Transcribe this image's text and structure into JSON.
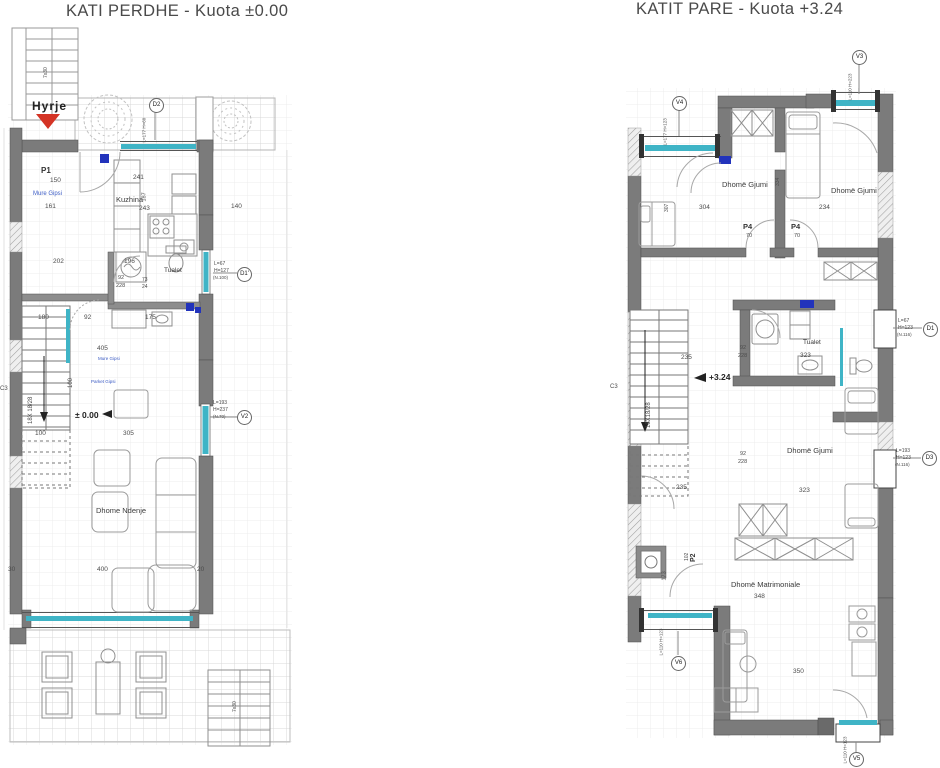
{
  "colors": {
    "accent_cyan": "#3fb4c6",
    "entrance_red": "#d43425",
    "note_blue": "#3b5bc4",
    "wall_gray": "#7b7b7b"
  },
  "left_plan": {
    "title": "KATI PERDHE - Kuota ±0.00",
    "entrance": "Hyrje",
    "level": "± 0.00",
    "rooms": {
      "kitchen": "Kuzhina",
      "toilet": "Tualet",
      "living": "Dhome Ndenje"
    },
    "notes": {
      "wall1": "Mure Gipsi",
      "wall2": "Mure Gipsi",
      "floor": "Parket Gipsi"
    },
    "tags": {
      "d2": "D2",
      "d1": "D1'",
      "v2": "V2"
    },
    "dims": [
      {
        "t": "7x30",
        "x": 49,
        "y": 78,
        "r": -90,
        "s": 5
      },
      {
        "t": "L=177 H=60",
        "x": 147,
        "y": 142,
        "r": -90,
        "s": 4.5
      },
      {
        "t": "P1",
        "x": 41,
        "y": 167,
        "s": 8,
        "c": "b"
      },
      {
        "t": "150",
        "x": 50,
        "y": 178,
        "s": 6.5
      },
      {
        "t": "241",
        "x": 133,
        "y": 175,
        "s": 6.5
      },
      {
        "t": "187",
        "x": 148,
        "y": 201,
        "r": -90,
        "s": 5.5
      },
      {
        "t": "243",
        "x": 139,
        "y": 206,
        "s": 6.5
      },
      {
        "t": "140",
        "x": 231,
        "y": 204,
        "s": 6.5
      },
      {
        "t": "161",
        "x": 45,
        "y": 204,
        "s": 6.5
      },
      {
        "t": "202",
        "x": 53,
        "y": 259,
        "s": 6.5
      },
      {
        "t": "196",
        "x": 124,
        "y": 259,
        "s": 6.5
      },
      {
        "t": "92",
        "x": 118,
        "y": 276,
        "s": 5.5
      },
      {
        "t": "228",
        "x": 116,
        "y": 284,
        "s": 5.5
      },
      {
        "t": "73",
        "x": 142,
        "y": 278,
        "s": 5
      },
      {
        "t": "24",
        "x": 142,
        "y": 285,
        "s": 5
      },
      {
        "t": "L=67",
        "x": 214,
        "y": 262,
        "s": 5
      },
      {
        "t": "H=127",
        "x": 214,
        "y": 269,
        "s": 5
      },
      {
        "t": "(N.100)",
        "x": 213,
        "y": 276,
        "s": 4.5
      },
      {
        "t": "180",
        "x": 38,
        "y": 315,
        "s": 6.5
      },
      {
        "t": "92",
        "x": 84,
        "y": 315,
        "s": 6.5
      },
      {
        "t": "175",
        "x": 145,
        "y": 315,
        "s": 6.5
      },
      {
        "t": "405",
        "x": 97,
        "y": 346,
        "s": 6.5
      },
      {
        "t": "100",
        "x": 74,
        "y": 388,
        "r": -90,
        "s": 6
      },
      {
        "t": "18X 18/28",
        "x": 34,
        "y": 424,
        "r": -90,
        "s": 6
      },
      {
        "t": "L=193",
        "x": 213,
        "y": 401,
        "s": 5
      },
      {
        "t": "H=237",
        "x": 213,
        "y": 408,
        "s": 5
      },
      {
        "t": "(N.70)",
        "x": 213,
        "y": 415,
        "s": 4.5
      },
      {
        "t": "100",
        "x": 35,
        "y": 431,
        "s": 6.5
      },
      {
        "t": "305",
        "x": 123,
        "y": 431,
        "s": 6.5
      },
      {
        "t": "30",
        "x": 8,
        "y": 567,
        "s": 6.5
      },
      {
        "t": "400",
        "x": 97,
        "y": 567,
        "s": 6.5
      },
      {
        "t": "20",
        "x": 197,
        "y": 567,
        "s": 6.5
      },
      {
        "t": "7x30",
        "x": 238,
        "y": 712,
        "r": -90,
        "s": 5
      },
      {
        "t": "C3",
        "x": 0,
        "y": 386,
        "s": 6
      }
    ]
  },
  "right_plan": {
    "title": "KATIT PARE -  Kuota +3.24",
    "level": "+3.24",
    "rooms": {
      "bedroom1": "Dhomë Gjumi",
      "bedroom2": "Dhomë Gjumi",
      "bedroom3": "Dhomë Gjumi",
      "toilet": "Tualet",
      "master": "Dhomë Matrimoniale"
    },
    "tags": {
      "v3": "V3",
      "v4": "V4",
      "d1": "D1",
      "d3": "D3",
      "v6": "V6",
      "v5": "V5"
    },
    "dims": [
      {
        "t": "L=110 H=223",
        "x": 853,
        "y": 100,
        "r": -90,
        "s": 4.5
      },
      {
        "t": "L=177 H=123",
        "x": 668,
        "y": 145,
        "r": -90,
        "s": 4.5
      },
      {
        "t": "307",
        "x": 670,
        "y": 212,
        "r": -90,
        "s": 5
      },
      {
        "t": "334",
        "x": 781,
        "y": 186,
        "r": -90,
        "s": 5
      },
      {
        "t": "304",
        "x": 699,
        "y": 205,
        "s": 6.5
      },
      {
        "t": "234",
        "x": 819,
        "y": 205,
        "s": 6.5
      },
      {
        "t": "P4",
        "x": 743,
        "y": 223,
        "s": 7.5,
        "c": "b"
      },
      {
        "t": "70",
        "x": 746,
        "y": 234,
        "s": 5.5
      },
      {
        "t": "P4",
        "x": 791,
        "y": 223,
        "s": 7.5,
        "c": "b"
      },
      {
        "t": "70",
        "x": 794,
        "y": 234,
        "s": 5.5
      },
      {
        "t": "235",
        "x": 681,
        "y": 355,
        "s": 6.5
      },
      {
        "t": "92",
        "x": 740,
        "y": 346,
        "s": 5.5
      },
      {
        "t": "228",
        "x": 738,
        "y": 354,
        "s": 5.5
      },
      {
        "t": "323",
        "x": 800,
        "y": 353,
        "s": 6.5
      },
      {
        "t": "L=67",
        "x": 898,
        "y": 319,
        "s": 5
      },
      {
        "t": "H=123",
        "x": 898,
        "y": 326,
        "s": 5
      },
      {
        "t": "(N.116)",
        "x": 897,
        "y": 333,
        "s": 4.5
      },
      {
        "t": "18X18/28",
        "x": 652,
        "y": 428,
        "r": -90,
        "s": 6
      },
      {
        "t": "235",
        "x": 676,
        "y": 485,
        "s": 6.5
      },
      {
        "t": "92",
        "x": 740,
        "y": 452,
        "s": 5.5
      },
      {
        "t": "228",
        "x": 738,
        "y": 460,
        "s": 5.5
      },
      {
        "t": "323",
        "x": 799,
        "y": 488,
        "s": 6.5
      },
      {
        "t": "L=193",
        "x": 896,
        "y": 449,
        "s": 5
      },
      {
        "t": "H=123",
        "x": 896,
        "y": 456,
        "s": 5
      },
      {
        "t": "(N.116)",
        "x": 895,
        "y": 463,
        "s": 4.5
      },
      {
        "t": "P2",
        "x": 697,
        "y": 562,
        "r": -90,
        "s": 7,
        "c": "b"
      },
      {
        "t": "102",
        "x": 690,
        "y": 561,
        "r": -90,
        "s": 5
      },
      {
        "t": "173",
        "x": 668,
        "y": 580,
        "r": -90,
        "s": 5.5
      },
      {
        "t": "348",
        "x": 754,
        "y": 594,
        "s": 6.5
      },
      {
        "t": "L=110 H=123",
        "x": 664,
        "y": 655,
        "r": -90,
        "s": 4.5
      },
      {
        "t": "350",
        "x": 793,
        "y": 669,
        "s": 6.5
      },
      {
        "t": "L=110 H=123",
        "x": 848,
        "y": 763,
        "r": -90,
        "s": 4.5
      },
      {
        "t": "C3",
        "x": 610,
        "y": 384,
        "s": 6
      }
    ]
  }
}
